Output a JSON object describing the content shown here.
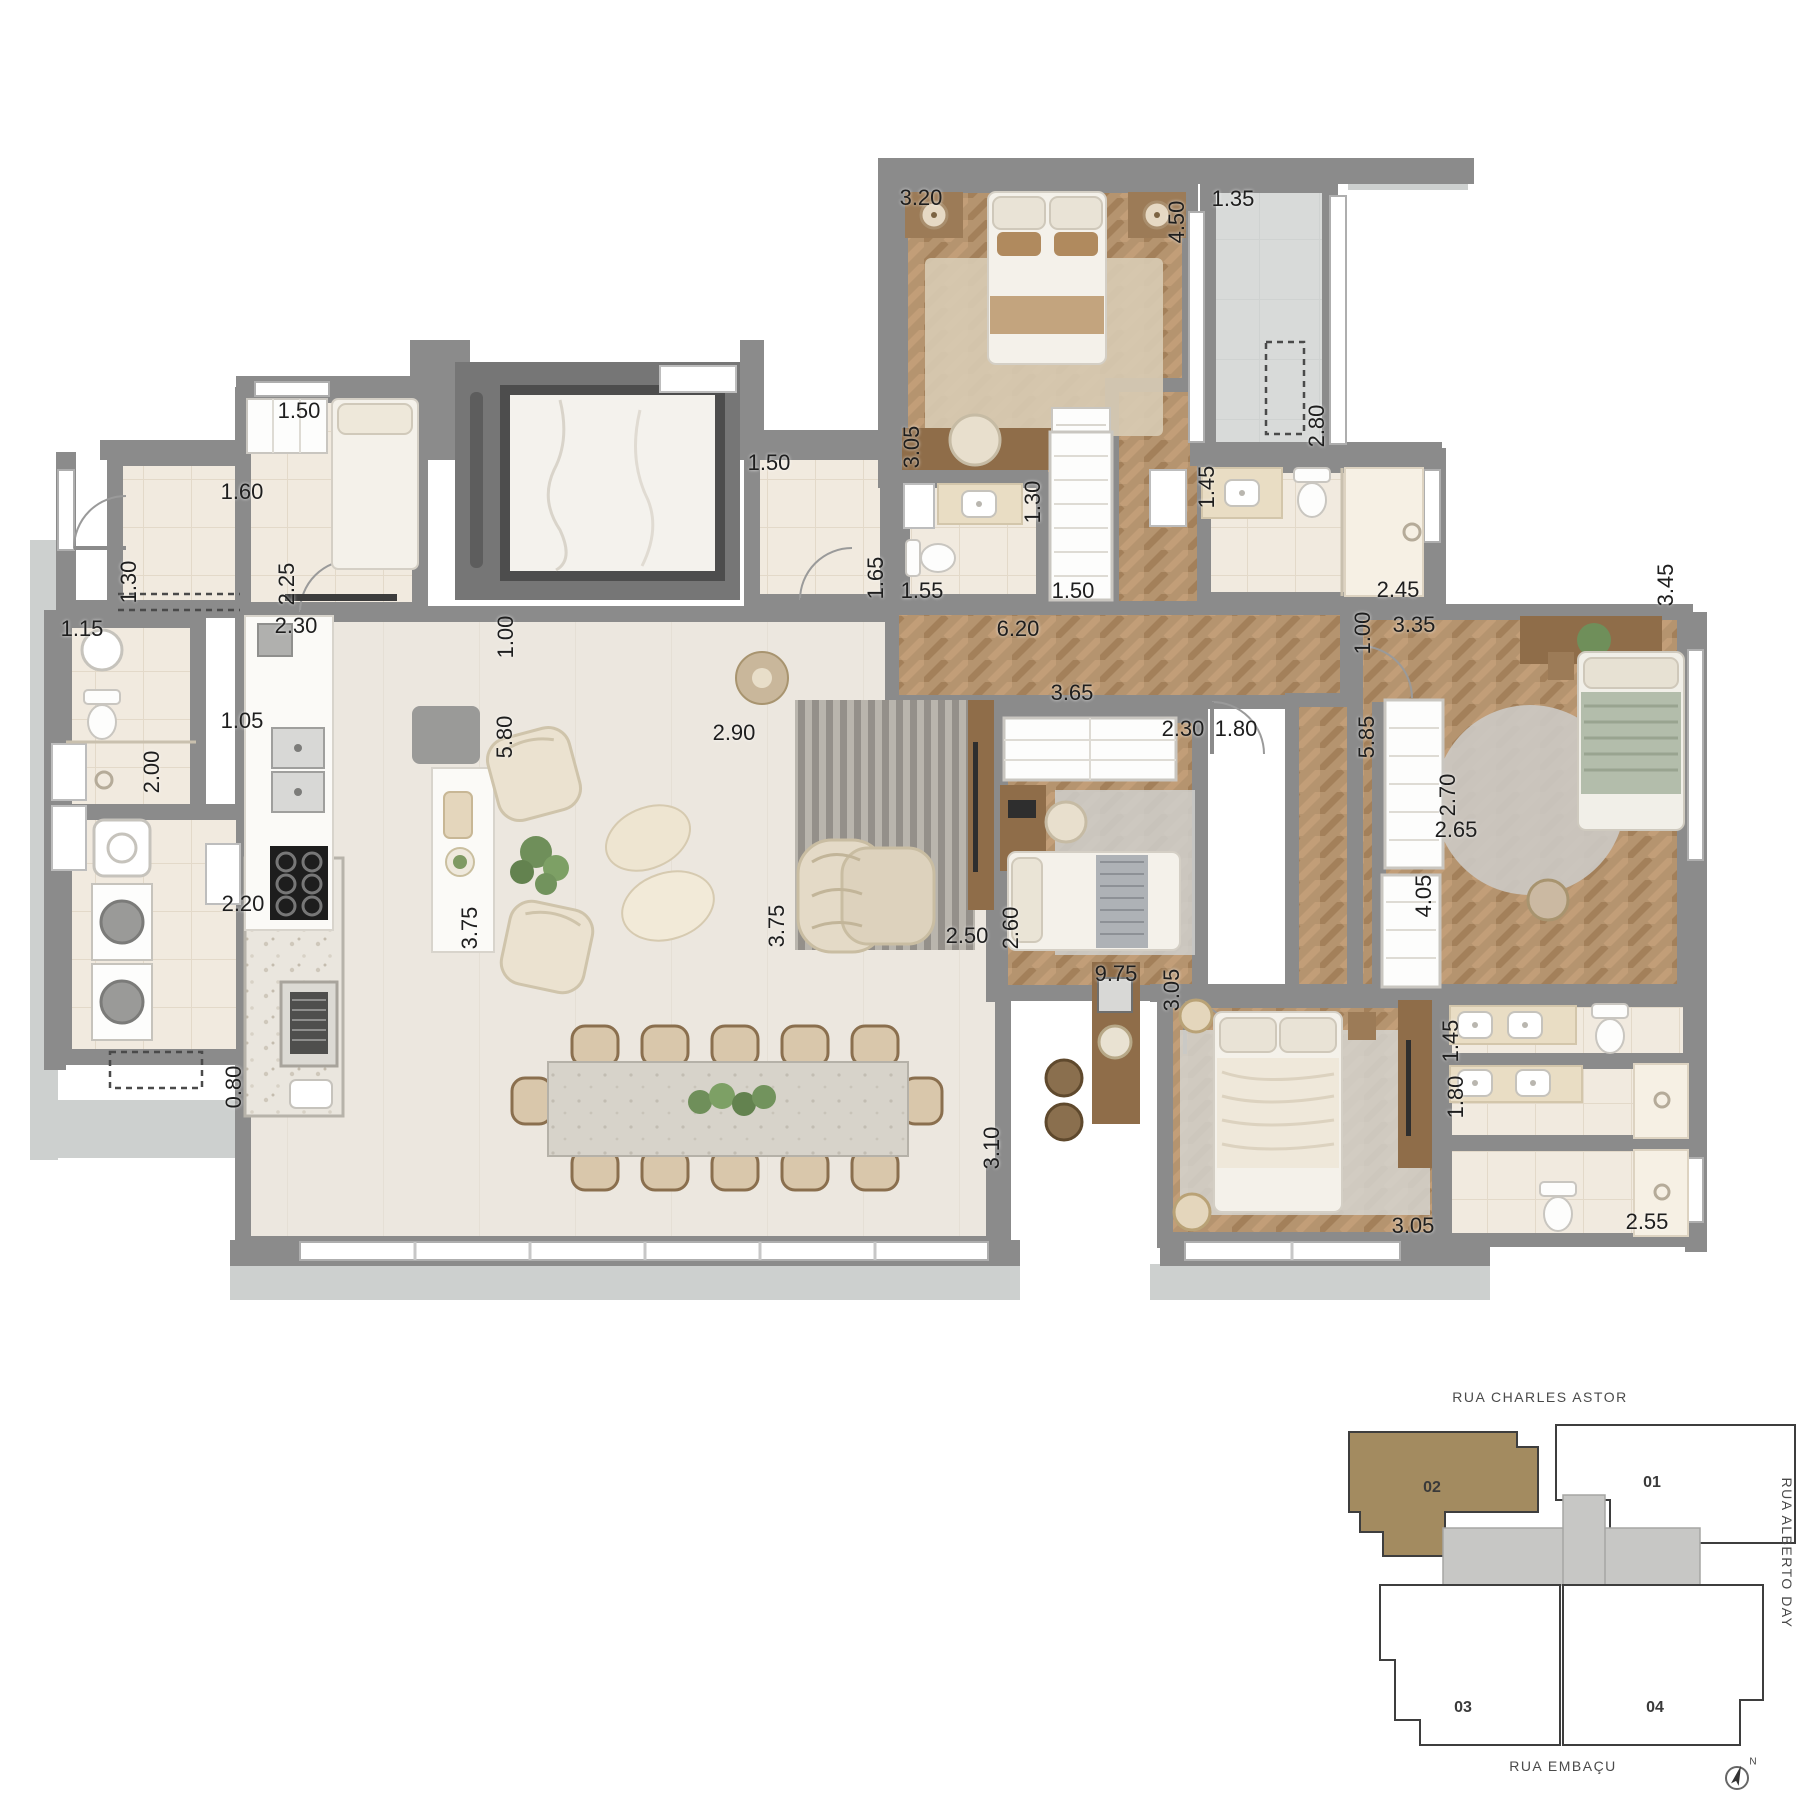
{
  "colors": {
    "wall": "#8b8b8b",
    "wood_floor": "#b5946f",
    "tile_floor": "#f1eadf",
    "balcony_floor": "#d8dad9",
    "unit_highlight": "#a38b60",
    "keyplan_core": "#c7c7c5"
  },
  "plan_labels": [
    {
      "t": "3.20",
      "x": 921,
      "y": 198,
      "r": 0
    },
    {
      "t": "4.50",
      "x": 1177,
      "y": 222,
      "r": 1
    },
    {
      "t": "1.35",
      "x": 1233,
      "y": 199,
      "r": 0
    },
    {
      "t": "2.80",
      "x": 1317,
      "y": 426,
      "r": 1
    },
    {
      "t": "3.05",
      "x": 912,
      "y": 447,
      "r": 1
    },
    {
      "t": "1.50",
      "x": 299,
      "y": 411,
      "r": 0
    },
    {
      "t": "2.25",
      "x": 287,
      "y": 584,
      "r": 1
    },
    {
      "t": "1.60",
      "x": 242,
      "y": 492,
      "r": 0
    },
    {
      "t": "1.30",
      "x": 129,
      "y": 582,
      "r": 1
    },
    {
      "t": "2.30",
      "x": 296,
      "y": 626,
      "r": 0
    },
    {
      "t": "1.15",
      "x": 82,
      "y": 629,
      "r": 0
    },
    {
      "t": "2.00",
      "x": 152,
      "y": 772,
      "r": 1
    },
    {
      "t": "1.05",
      "x": 242,
      "y": 721,
      "r": 0
    },
    {
      "t": "2.20",
      "x": 243,
      "y": 904,
      "r": 0
    },
    {
      "t": "0.80",
      "x": 234,
      "y": 1087,
      "r": 1
    },
    {
      "t": "1.00",
      "x": 506,
      "y": 637,
      "r": 1
    },
    {
      "t": "1.50",
      "x": 769,
      "y": 463,
      "r": 0
    },
    {
      "t": "1.65",
      "x": 876,
      "y": 578,
      "r": 1
    },
    {
      "t": "1.55",
      "x": 922,
      "y": 591,
      "r": 0
    },
    {
      "t": "1.30",
      "x": 1033,
      "y": 502,
      "r": 1
    },
    {
      "t": "6.20",
      "x": 1018,
      "y": 629,
      "r": 0
    },
    {
      "t": "1.50",
      "x": 1073,
      "y": 591,
      "r": 0
    },
    {
      "t": "1.45",
      "x": 1207,
      "y": 487,
      "r": 1
    },
    {
      "t": "2.45",
      "x": 1398,
      "y": 590,
      "r": 0
    },
    {
      "t": "1.00",
      "x": 1363,
      "y": 633,
      "r": 1
    },
    {
      "t": "3.35",
      "x": 1414,
      "y": 625,
      "r": 0
    },
    {
      "t": "3.65",
      "x": 1072,
      "y": 693,
      "r": 0
    },
    {
      "t": "2.30",
      "x": 1183,
      "y": 729,
      "r": 0
    },
    {
      "t": "1.80",
      "x": 1236,
      "y": 729,
      "r": 0
    },
    {
      "t": "5.85",
      "x": 1367,
      "y": 737,
      "r": 1
    },
    {
      "t": "3.45",
      "x": 1666,
      "y": 585,
      "r": 1
    },
    {
      "t": "2.70",
      "x": 1448,
      "y": 795,
      "r": 1
    },
    {
      "t": "2.65",
      "x": 1456,
      "y": 830,
      "r": 0
    },
    {
      "t": "5.80",
      "x": 505,
      "y": 737,
      "r": 1
    },
    {
      "t": "2.90",
      "x": 734,
      "y": 733,
      "r": 0
    },
    {
      "t": "3.75",
      "x": 470,
      "y": 928,
      "r": 1
    },
    {
      "t": "3.75",
      "x": 777,
      "y": 926,
      "r": 1
    },
    {
      "t": "2.50",
      "x": 967,
      "y": 936,
      "r": 0
    },
    {
      "t": "2.60",
      "x": 1011,
      "y": 928,
      "r": 1
    },
    {
      "t": "9.75",
      "x": 1116,
      "y": 974,
      "r": 0
    },
    {
      "t": "3.05",
      "x": 1172,
      "y": 990,
      "r": 1
    },
    {
      "t": "4.05",
      "x": 1424,
      "y": 896,
      "r": 1
    },
    {
      "t": "3.10",
      "x": 992,
      "y": 1148,
      "r": 1
    },
    {
      "t": "3.05",
      "x": 1413,
      "y": 1226,
      "r": 0
    },
    {
      "t": "1.45",
      "x": 1451,
      "y": 1041,
      "r": 1
    },
    {
      "t": "1.80",
      "x": 1456,
      "y": 1097,
      "r": 1
    },
    {
      "t": "2.55",
      "x": 1647,
      "y": 1222,
      "r": 0
    }
  ],
  "keyplan": {
    "street_top": "RUA CHARLES ASTOR",
    "street_right": "RUA ALBERTO DAY",
    "street_bottom": "RUA EMBAÇU",
    "north": "N",
    "highlight_color": "#a38b60",
    "units": [
      {
        "t": "02",
        "x": 1432,
        "y": 1488,
        "highlighted": true
      },
      {
        "t": "01",
        "x": 1652,
        "y": 1483,
        "highlighted": false
      },
      {
        "t": "03",
        "x": 1463,
        "y": 1708,
        "highlighted": false
      },
      {
        "t": "04",
        "x": 1655,
        "y": 1708,
        "highlighted": false
      }
    ]
  }
}
